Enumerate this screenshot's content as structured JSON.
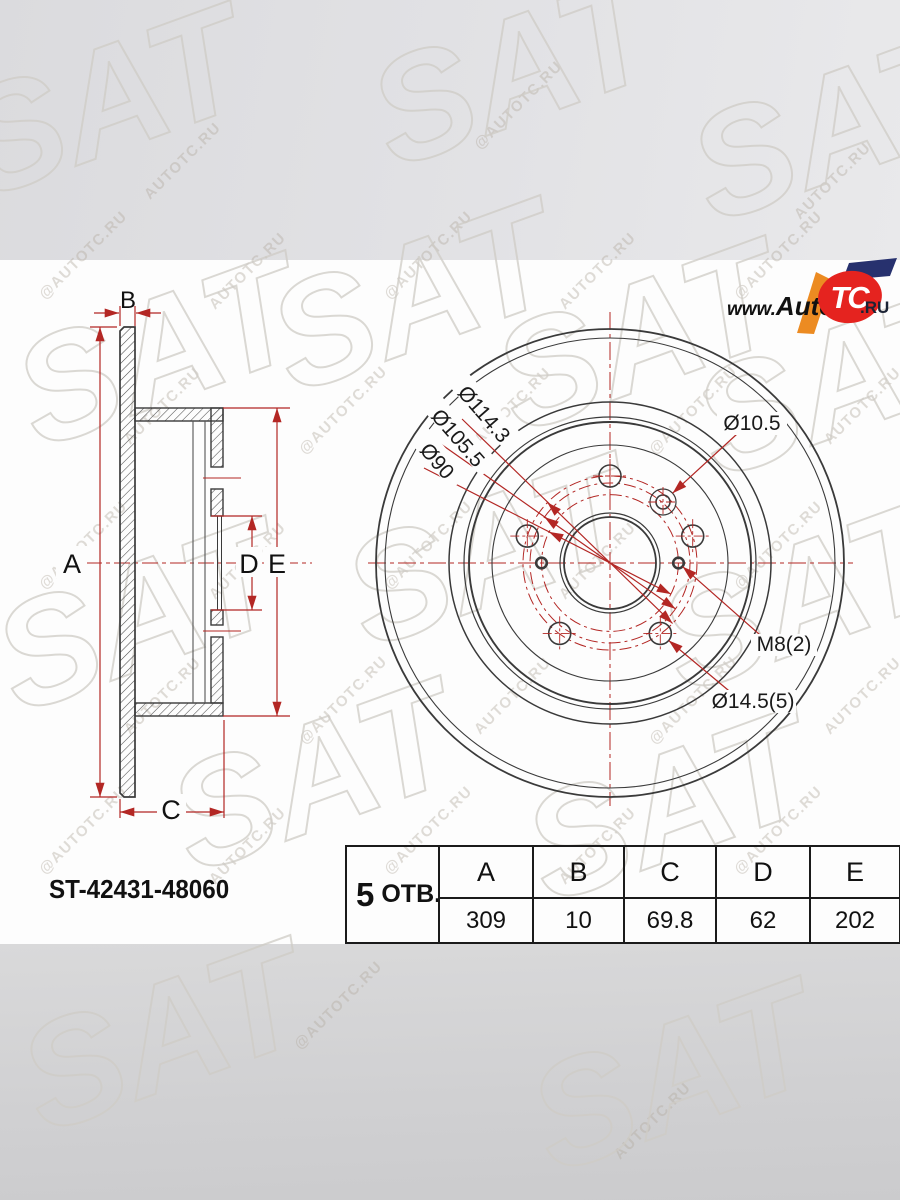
{
  "watermark": {
    "small": "AUTOTC.RU",
    "small_at": "@AUTOTC.RU",
    "large": "SAT"
  },
  "logo": {
    "www": "www.",
    "auto": "Auto",
    "tc": "TC",
    "ru": ".RU"
  },
  "part_number": "ST-42431-48060",
  "holes": {
    "count": "5",
    "suffix": "ОТВ."
  },
  "dim_labels": {
    "a": "A",
    "b": "B",
    "c": "C",
    "d": "D",
    "e": "E"
  },
  "front_labels": {
    "pcd_outer": "Ø114.3",
    "pcd_mid": "Ø105.5",
    "pcd_inner": "Ø90",
    "pilot_hole": "Ø10.5",
    "service_hole": "M8(2)",
    "bolt_hole": "Ø14.5(5)"
  },
  "table": {
    "headers": [
      "A",
      "B",
      "C",
      "D",
      "E"
    ],
    "values": [
      "309",
      "10",
      "69.8",
      "62",
      "202"
    ]
  },
  "colors": {
    "dimension_red": "#b32724",
    "line_dark": "#3a3a3a",
    "logo_red": "#e5231f",
    "logo_orange": "#ec8b22",
    "logo_blue": "#27316e"
  }
}
